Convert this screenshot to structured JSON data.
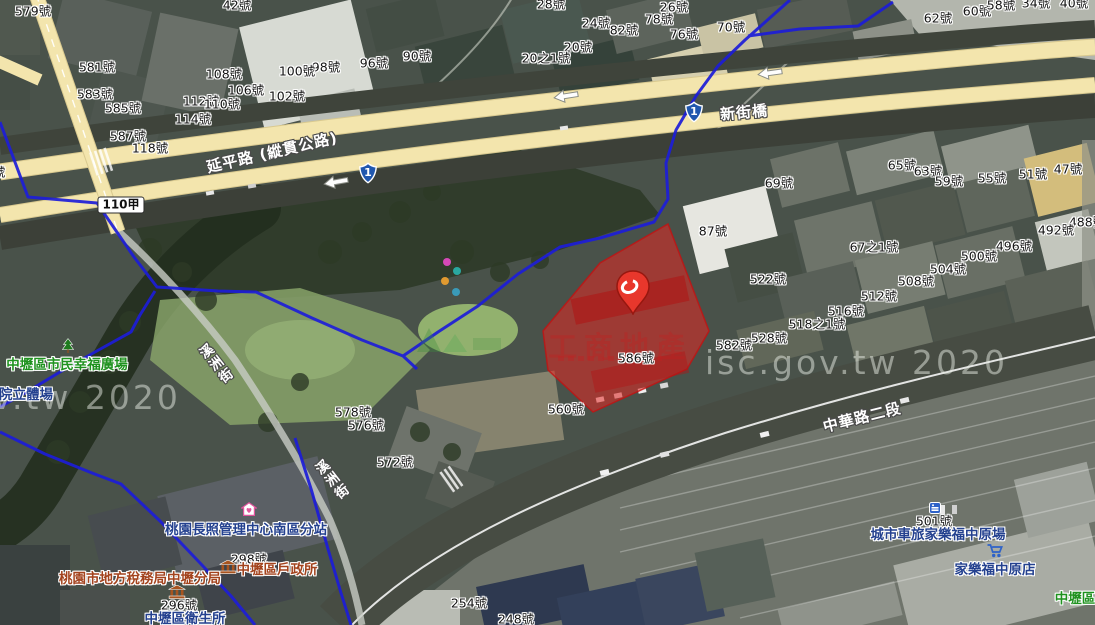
{
  "watermarks": {
    "bottom_left": "v.tw 2020",
    "right": "isc.gov.tw 2020",
    "red_overlay": "工商地產"
  },
  "road_labels": [
    {
      "t": "延平路 (縱貫公路)",
      "x": 272,
      "y": 152,
      "rot": -13,
      "v": false
    },
    {
      "t": "新街橋",
      "x": 744,
      "y": 112,
      "rot": -5,
      "v": false
    },
    {
      "t": "中華路二段",
      "x": 862,
      "y": 417,
      "rot": -14,
      "v": false
    },
    {
      "t": "溪洲街",
      "x": 215,
      "y": 365,
      "rot": -38,
      "v": true
    },
    {
      "t": "溪洲街",
      "x": 331,
      "y": 481,
      "rot": -38,
      "v": true
    }
  ],
  "route_shields": [
    {
      "num": "1",
      "x": 368,
      "y": 173
    },
    {
      "num": "1",
      "x": 694,
      "y": 112
    }
  ],
  "road_badges": [
    {
      "t": "110甲",
      "x": 121,
      "y": 205
    }
  ],
  "arrows": [
    {
      "x": 336,
      "y": 182,
      "rot": -10
    },
    {
      "x": 566,
      "y": 96,
      "rot": -9
    },
    {
      "x": 770,
      "y": 73,
      "rot": -8
    }
  ],
  "house_numbers": [
    {
      "t": "579號",
      "x": 33,
      "y": 10
    },
    {
      "t": "42號",
      "x": 237,
      "y": 4
    },
    {
      "t": "28號",
      "x": 551,
      "y": 3
    },
    {
      "t": "26號",
      "x": 674,
      "y": 6
    },
    {
      "t": "24號",
      "x": 596,
      "y": 22
    },
    {
      "t": "82號",
      "x": 624,
      "y": 29
    },
    {
      "t": "78號",
      "x": 659,
      "y": 18
    },
    {
      "t": "76號",
      "x": 684,
      "y": 33
    },
    {
      "t": "70號",
      "x": 731,
      "y": 26
    },
    {
      "t": "20號",
      "x": 578,
      "y": 46
    },
    {
      "t": "20之1號",
      "x": 546,
      "y": 57
    },
    {
      "t": "90號",
      "x": 417,
      "y": 55
    },
    {
      "t": "96號",
      "x": 374,
      "y": 62
    },
    {
      "t": "98號",
      "x": 326,
      "y": 66
    },
    {
      "t": "100號",
      "x": 297,
      "y": 70
    },
    {
      "t": "108號",
      "x": 224,
      "y": 73
    },
    {
      "t": "106號",
      "x": 246,
      "y": 89
    },
    {
      "t": "102號",
      "x": 287,
      "y": 95
    },
    {
      "t": "112號",
      "x": 201,
      "y": 100
    },
    {
      "t": "110號",
      "x": 222,
      "y": 103
    },
    {
      "t": "114號",
      "x": 193,
      "y": 118
    },
    {
      "t": "581號",
      "x": 97,
      "y": 66
    },
    {
      "t": "583號",
      "x": 95,
      "y": 93
    },
    {
      "t": "585號",
      "x": 123,
      "y": 107
    },
    {
      "t": "587號",
      "x": 128,
      "y": 135
    },
    {
      "t": "118號",
      "x": 150,
      "y": 147
    },
    {
      "t": "8號",
      "x": -5,
      "y": 171
    },
    {
      "t": "62號",
      "x": 938,
      "y": 17
    },
    {
      "t": "60號",
      "x": 977,
      "y": 10
    },
    {
      "t": "58號",
      "x": 1001,
      "y": 4
    },
    {
      "t": "34號",
      "x": 1036,
      "y": 2
    },
    {
      "t": "40號",
      "x": 1074,
      "y": 2
    },
    {
      "t": "65號",
      "x": 902,
      "y": 164
    },
    {
      "t": "63號",
      "x": 928,
      "y": 170
    },
    {
      "t": "59號",
      "x": 949,
      "y": 180
    },
    {
      "t": "55號",
      "x": 992,
      "y": 177
    },
    {
      "t": "51號",
      "x": 1033,
      "y": 173
    },
    {
      "t": "47號",
      "x": 1068,
      "y": 168
    },
    {
      "t": "69號",
      "x": 779,
      "y": 182
    },
    {
      "t": "87號",
      "x": 713,
      "y": 230
    },
    {
      "t": "67之1號",
      "x": 874,
      "y": 246
    },
    {
      "t": "522號",
      "x": 768,
      "y": 278
    },
    {
      "t": "512號",
      "x": 879,
      "y": 295
    },
    {
      "t": "516號",
      "x": 846,
      "y": 310
    },
    {
      "t": "518之1號",
      "x": 817,
      "y": 323
    },
    {
      "t": "528號",
      "x": 769,
      "y": 337
    },
    {
      "t": "582號",
      "x": 734,
      "y": 344
    },
    {
      "t": "586號",
      "x": 636,
      "y": 357
    },
    {
      "t": "488號",
      "x": 1087,
      "y": 221
    },
    {
      "t": "492號",
      "x": 1056,
      "y": 229
    },
    {
      "t": "496號",
      "x": 1014,
      "y": 245
    },
    {
      "t": "500號",
      "x": 979,
      "y": 255
    },
    {
      "t": "504號",
      "x": 948,
      "y": 268
    },
    {
      "t": "508號",
      "x": 916,
      "y": 280
    },
    {
      "t": "560號",
      "x": 566,
      "y": 408
    },
    {
      "t": "578號",
      "x": 353,
      "y": 411
    },
    {
      "t": "576號",
      "x": 366,
      "y": 424
    },
    {
      "t": "572號",
      "x": 395,
      "y": 461
    },
    {
      "t": "298號",
      "x": 249,
      "y": 558
    },
    {
      "t": "296號",
      "x": 179,
      "y": 604
    },
    {
      "t": "501號",
      "x": 934,
      "y": 520
    },
    {
      "t": "254號",
      "x": 469,
      "y": 602
    },
    {
      "t": "248號",
      "x": 516,
      "y": 618
    }
  ],
  "pois": [
    {
      "t": "中壢區市民幸福廣場",
      "x": 67,
      "y": 363,
      "color": "green"
    },
    {
      "t": "院立體場",
      "x": 26,
      "y": 393,
      "color": "navy"
    },
    {
      "t": "桃園長照管理中心南區分站",
      "x": 246,
      "y": 528,
      "color": "navy"
    },
    {
      "t": "中壢區戶政所",
      "x": 277,
      "y": 568,
      "color": "brown"
    },
    {
      "t": "桃園市地方稅務局中壢分局",
      "x": 140,
      "y": 577,
      "color": "brown"
    },
    {
      "t": "中壢區衛生所",
      "x": 185,
      "y": 617,
      "color": "navy"
    },
    {
      "t": "城市車旅家樂福中原場",
      "x": 938,
      "y": 533,
      "color": "navy"
    },
    {
      "t": "家樂福中原店",
      "x": 995,
      "y": 568,
      "color": "navy"
    },
    {
      "t": "中壢區",
      "x": 1075,
      "y": 597,
      "color": "green"
    }
  ],
  "poi_icons": [
    {
      "type": "tree",
      "x": 68,
      "y": 346
    },
    {
      "type": "care-home",
      "x": 249,
      "y": 509
    },
    {
      "type": "gov-building",
      "x": 228,
      "y": 567
    },
    {
      "type": "gov-building",
      "x": 177,
      "y": 592
    },
    {
      "type": "motel",
      "x": 935,
      "y": 508
    },
    {
      "type": "shopping-cart",
      "x": 995,
      "y": 551
    }
  ],
  "colors": {
    "road_yellow": "#f3e5ad",
    "boundary_blue": "#1d1dd8",
    "parcel_red": "rgba(228,38,34,0.55)",
    "pin_red": "#e8372c",
    "poi_navy": "#24418f",
    "poi_green": "#1f921f",
    "poi_brown": "#a3431d"
  }
}
